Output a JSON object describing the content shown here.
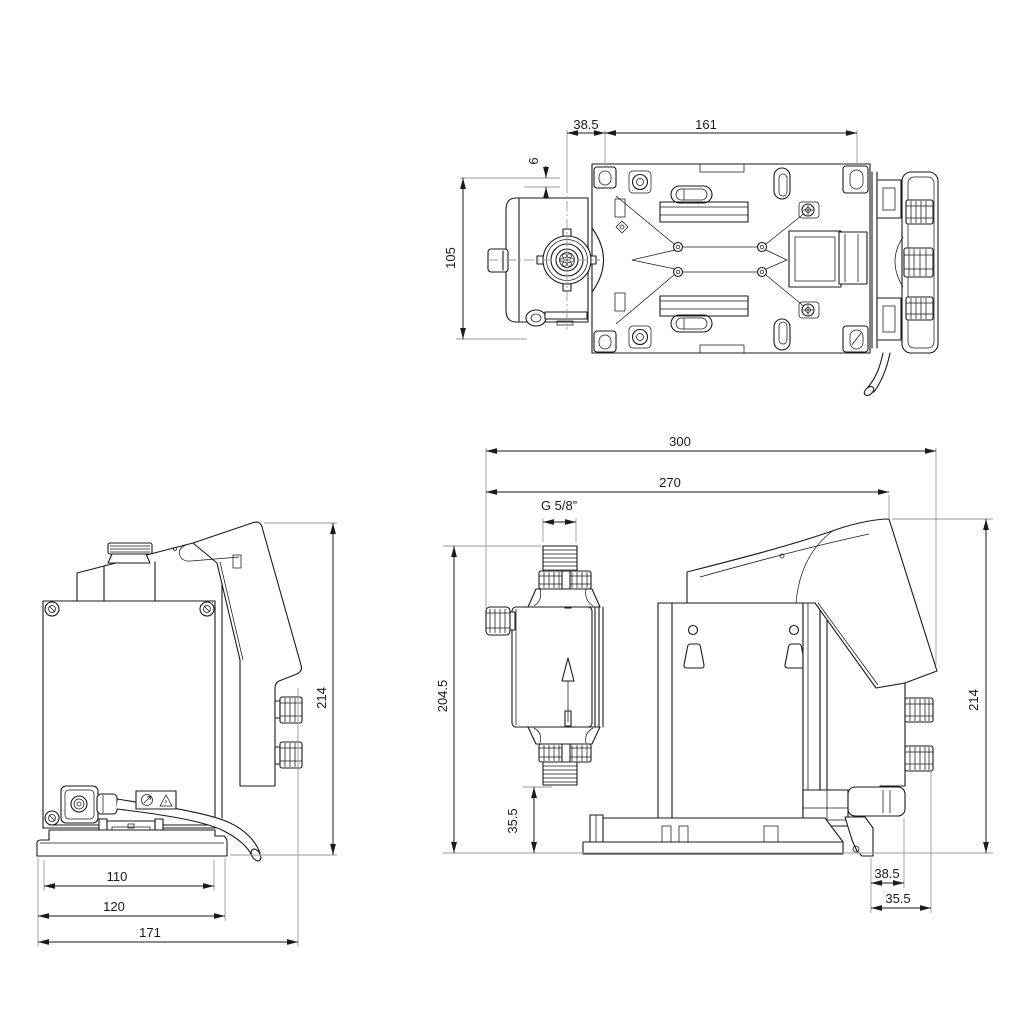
{
  "drawing": {
    "background": "#ffffff",
    "ink_color": "#1a1a1a",
    "extension_line_color": "#9a9a9a",
    "views": {
      "top": {
        "label": "top-view",
        "dims": {
          "hole_offset": "38.5",
          "hole_spacing": "161",
          "edge_gap": "6",
          "width": "105"
        }
      },
      "back": {
        "label": "back-side-view",
        "dims": {
          "height": "214",
          "plate_width": "110",
          "base_width": "120",
          "overall_depth": "171"
        }
      },
      "side": {
        "label": "right-side-view",
        "dims": {
          "total_length": "300",
          "body_length": "270",
          "thread": "G 5/8”",
          "connection_height": "204.5",
          "suction_height": "35.5",
          "height": "214",
          "rail_offset": "38.5",
          "knob_offset": "35.5"
        }
      }
    }
  }
}
